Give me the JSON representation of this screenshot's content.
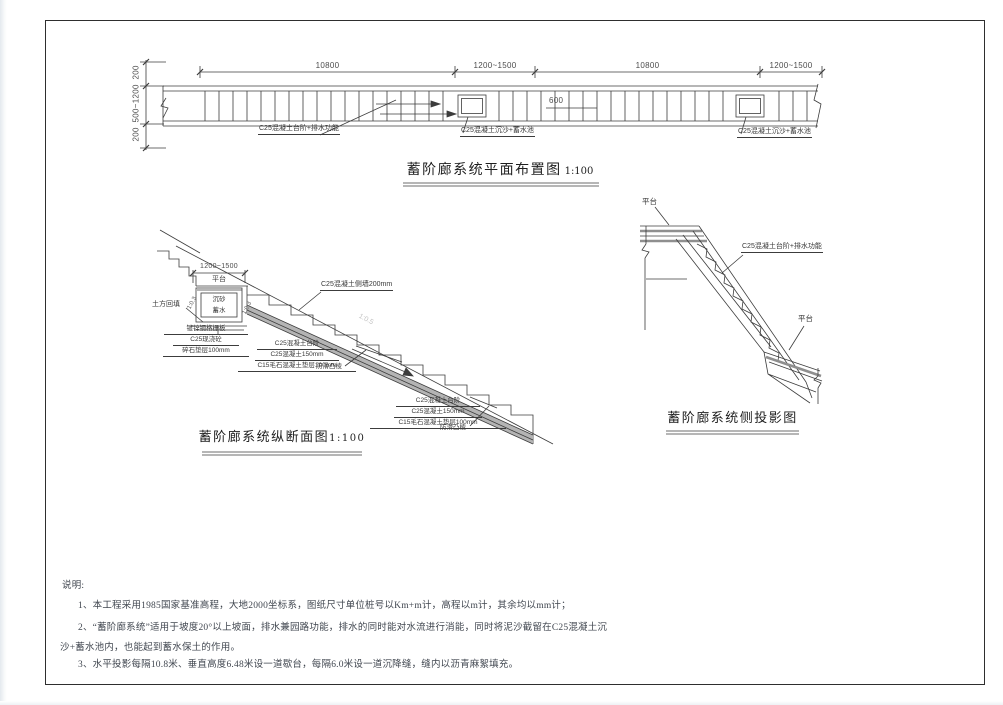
{
  "drawing": {
    "plan": {
      "title": "蓄阶廊系统平面布置图",
      "scale": "1:100",
      "dim_top_1": "10800",
      "dim_top_2": "1200~1500",
      "dim_top_3": "10800",
      "dim_top_4": "1200~1500",
      "dim_left_top": "200",
      "dim_left_mid": "500~1200",
      "dim_left_bottom": "200",
      "dim_pool": "600",
      "label_steps": "C25混凝土台阶+排水功能",
      "label_pool": "C25混凝土沉沙+蓄水池"
    },
    "section": {
      "title": "蓄阶廊系统纵断面图",
      "scale": "1:100",
      "dim_platform": "1200~1500",
      "label_platform": "平台",
      "pit_text_1": "沉砂",
      "pit_text_2": "蓄水",
      "label_backfill": "土方回填",
      "label_grating": "镀锌钢格栅板",
      "label_cast": "C25现浇砼",
      "label_gravel": "碎石垫层100mm",
      "label_step": "C25混凝土台阶",
      "label_slab": "C25混凝土150mm",
      "label_cushion": "C15毛石混凝土垫层100mm",
      "label_antislip": "防滑凸棱",
      "label_sidewall": "C25混凝土侧墙200mm",
      "slope_left": "1:0.3",
      "slope_right": "1:0.3",
      "slope_main": "1:0.5"
    },
    "side": {
      "title": "蓄阶廊系统侧投影图",
      "label_platform_top": "平台",
      "label_platform_bottom": "平台",
      "label_steps": "C25混凝土台阶+排水功能"
    },
    "notes": {
      "heading": "说明:",
      "lines": [
        "1、本工程采用1985国家基准高程，大地2000坐标系，图纸尺寸单位桩号以Km+m计，高程以m计，其余均以mm计；",
        "2、“蓄阶廊系统”适用于坡度20°以上坡面，排水兼园路功能，排水的同时能对水流进行消能，同时将泥沙截留在C25混凝土沉",
        "沙+蓄水池内，也能起到蓄水保土的作用。",
        "3、水平投影每隔10.8米、垂直高度6.48米设一道歇台，每隔6.0米设一道沉降缝，缝内以沥青麻絮填充。"
      ]
    }
  }
}
